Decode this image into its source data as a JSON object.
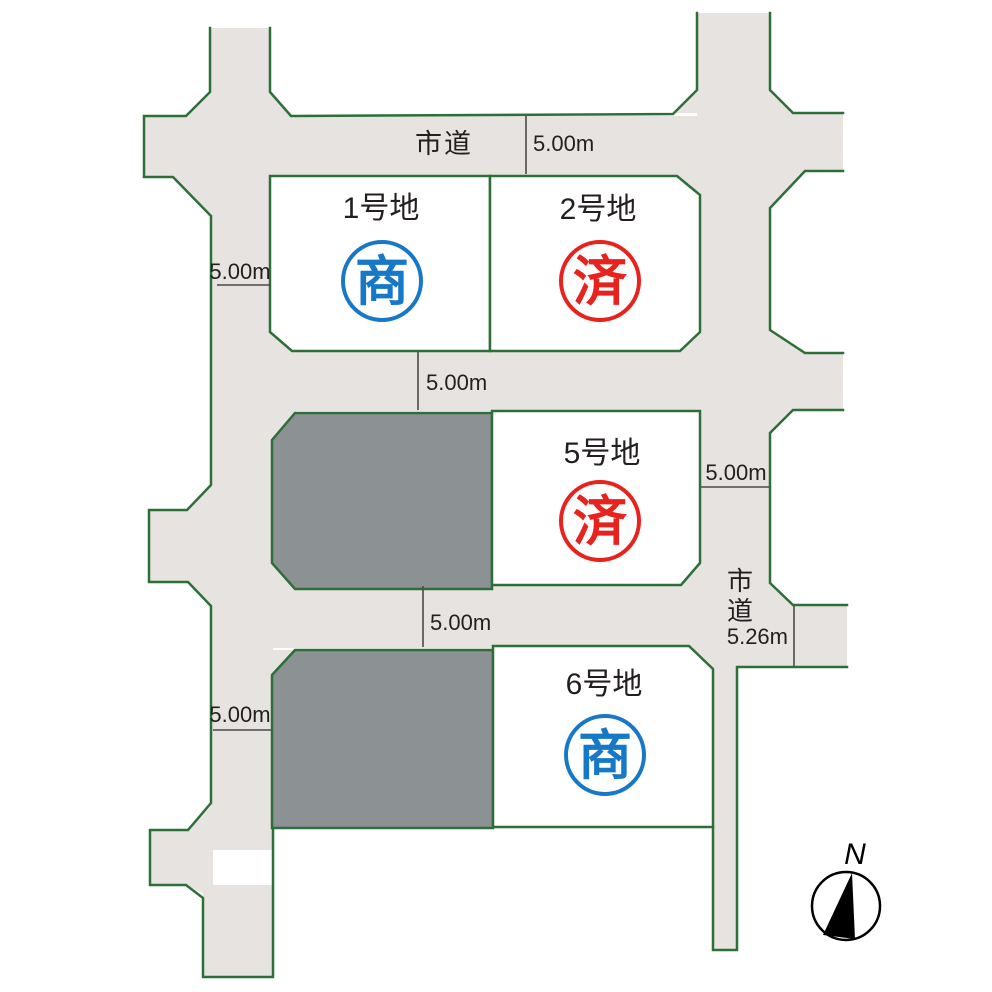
{
  "roads": {
    "city_road_top": "市道",
    "city_road_right_chars": [
      "市",
      "道"
    ]
  },
  "dimensions": {
    "top_road_width": "5.00m",
    "left_road_width_upper": "5.00m",
    "middle_road_width": "5.00m",
    "right_road_width": "5.00m",
    "lower_middle_road_width": "5.00m",
    "left_road_width_lower": "5.00m",
    "southeast_road_width": "5.26m"
  },
  "plots": [
    {
      "label": "1号地",
      "stamp": "商",
      "stamp_color": "#1878c8"
    },
    {
      "label": "2号地",
      "stamp": "済",
      "stamp_color": "#e8231d"
    },
    {
      "label": "5号地",
      "stamp": "済",
      "stamp_color": "#e8231d"
    },
    {
      "label": "6号地",
      "stamp": "商",
      "stamp_color": "#1878c8"
    }
  ],
  "compass": {
    "label": "N"
  },
  "colors": {
    "road_fill": "#e6e3e0",
    "border_green": "#2e6f39",
    "sold_plot_gray": "#8c9194",
    "stamp_blue": "#1878c8",
    "stamp_red": "#e8231d",
    "text": "#231f20"
  }
}
